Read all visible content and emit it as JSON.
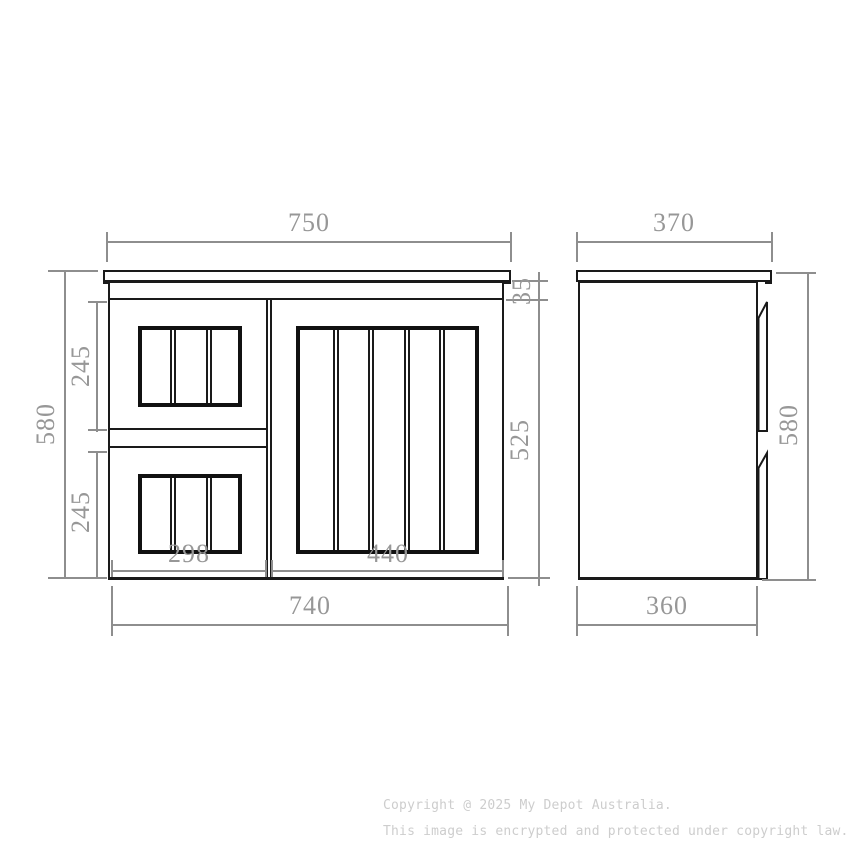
{
  "drawing": {
    "type": "technical-dimension-diagram",
    "units": "mm",
    "front_view": {
      "dims": {
        "top_width": {
          "value": "750",
          "orientation": "horizontal",
          "refers_to": "countertop width"
        },
        "counter_thickness": {
          "value": "35",
          "orientation": "vertical",
          "refers_to": "countertop thickness"
        },
        "total_height": {
          "value": "580",
          "orientation": "vertical",
          "refers_to": "overall height"
        },
        "drawer1_height": {
          "value": "245",
          "orientation": "vertical",
          "refers_to": "upper drawer front height"
        },
        "drawer2_height": {
          "value": "245",
          "orientation": "vertical",
          "refers_to": "lower drawer front height"
        },
        "front_height": {
          "value": "525",
          "orientation": "vertical",
          "refers_to": "door front height"
        },
        "drawer_width": {
          "value": "298",
          "orientation": "horizontal",
          "refers_to": "drawer bank width"
        },
        "door_width": {
          "value": "440",
          "orientation": "horizontal",
          "refers_to": "door width"
        },
        "body_width": {
          "value": "740",
          "orientation": "horizontal",
          "refers_to": "cabinet body width"
        }
      }
    },
    "side_view": {
      "dims": {
        "top_depth": {
          "value": "370",
          "orientation": "horizontal",
          "refers_to": "countertop depth"
        },
        "height": {
          "value": "580",
          "orientation": "vertical",
          "refers_to": "overall height"
        },
        "body_depth": {
          "value": "360",
          "orientation": "horizontal",
          "refers_to": "cabinet body depth"
        }
      }
    },
    "colors": {
      "outline": "#1a1a1a",
      "dimension_line": "#8e8e8e",
      "dimension_text": "#979797",
      "watermark_text": "#cdcdcd",
      "background": "#ffffff"
    }
  },
  "watermark": {
    "line1": "Copyright @ 2025 My Depot Australia.",
    "line2": "This image is encrypted and protected under copyright law."
  }
}
